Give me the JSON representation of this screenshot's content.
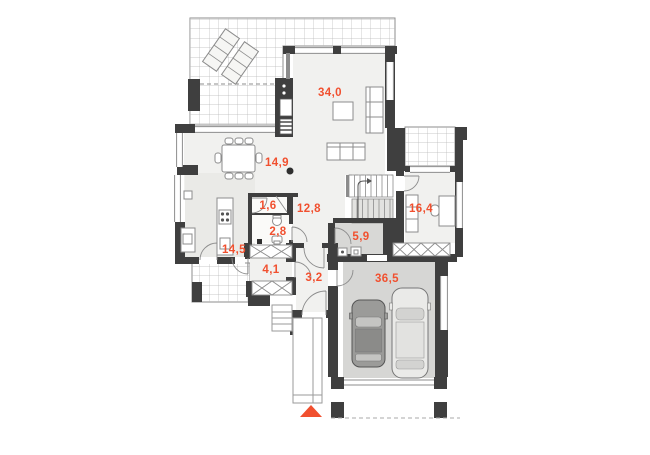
{
  "plan": {
    "title": "House ground floor plan",
    "accent_color": "#f1502f",
    "wall_color": "#3f3f3f",
    "line_color": "#8c8c8c",
    "floor_color": "#f1f1ef",
    "gray_floor_color": "#d8d8d6",
    "rooms": [
      {
        "id": "living-room",
        "area": "34,0"
      },
      {
        "id": "dining-room",
        "area": "14,9"
      },
      {
        "id": "pantry",
        "area": "1,6"
      },
      {
        "id": "hall",
        "area": "12,8"
      },
      {
        "id": "office",
        "area": "16,4"
      },
      {
        "id": "wc",
        "area": "2,8"
      },
      {
        "id": "utility",
        "area": "5,9"
      },
      {
        "id": "kitchen",
        "area": "14,5"
      },
      {
        "id": "wardrobe-hall",
        "area": "4,1"
      },
      {
        "id": "vestibule",
        "area": "3,2"
      },
      {
        "id": "garage",
        "area": "36,5"
      }
    ]
  }
}
